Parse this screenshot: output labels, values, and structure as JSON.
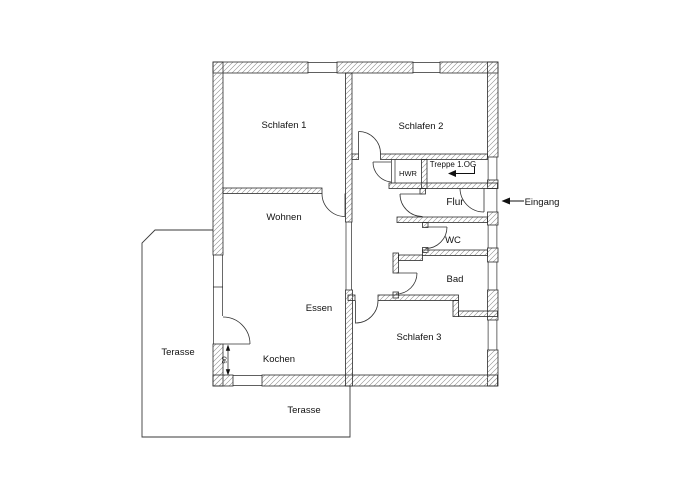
{
  "drawing": {
    "type": "apartment-floor-plan",
    "colors": {
      "background": "#ffffff",
      "wall_outline": "#2b2b2b",
      "wall_hatch": "#8a8a8a",
      "text": "#111111"
    },
    "rooms": {
      "schlafen1": "Schlafen 1",
      "schlafen2": "Schlafen 2",
      "wohnen": "Wohnen",
      "essen": "Essen",
      "kochen": "Kochen",
      "schlafen3": "Schlafen 3",
      "flur": "Flur",
      "wc": "WC",
      "bad": "Bad",
      "hwr": "HWR"
    },
    "annotations": {
      "stairs": "Treppe 1.OG",
      "entrance": "Eingang",
      "terrace_left": "Terasse",
      "terrace_bottom": "Terasse",
      "door_width_cm": "90"
    }
  }
}
